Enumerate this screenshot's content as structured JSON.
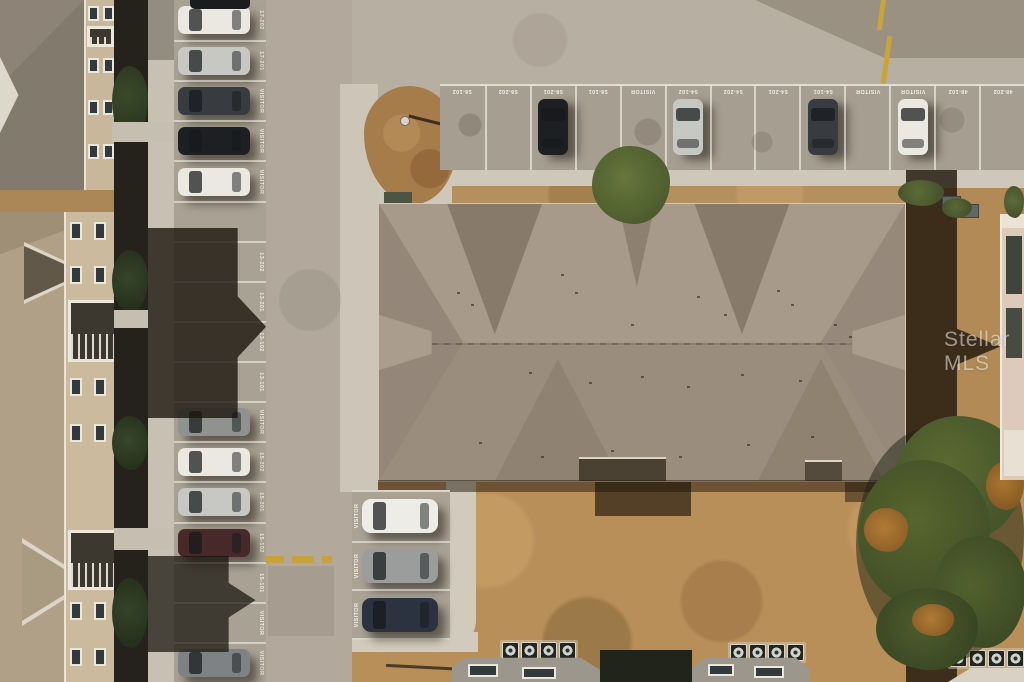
{
  "scene": {
    "type": "aerial-drone-photo",
    "description": "Overhead aerial photo of a condominium complex: large taupe hip roof at center, perpendicular parking rows at top and left with painted unit-number stall labels, dry brown lawn below, AC units along lower buildings, autumn trees at lower right.",
    "watermark": "Stellar MLS"
  },
  "palette": {
    "road": "#b7afa2",
    "parking_asphalt": "#a69e90",
    "dark_pavement_patch": "#9a9182",
    "main_roof": "#a39485",
    "roof_shadow": "rgba(33,24,14,0.8)",
    "sidewalk": "#cfc8ba",
    "dry_grass": "#b88f58",
    "mulch_island": "#a67c4b",
    "tree_green": "#57652f",
    "tree_orange": "#b07c35",
    "building_wall": "#cbb99d",
    "left_roof_tan": "#b0a088",
    "stall_line": "#f8f6ee",
    "yellow_marking": "#c9a43a"
  },
  "car_colors": {
    "white": "#eae8e1",
    "silver": "#c7c8c4",
    "black": "#1d1f22",
    "darkgray": "#383c40",
    "graysuv": "#8f928f",
    "maroon": "#47292a",
    "gray": "#7e8284",
    "navy": "#2c3340",
    "whitesuv": "#edece6",
    "graysedan": "#9a9d9b"
  },
  "top_parking": {
    "stalls": [
      {
        "label": "58-102"
      },
      {
        "label": "58-202"
      },
      {
        "label": "58-201",
        "car": "black"
      },
      {
        "label": "58-101"
      },
      {
        "label": "VISITOR"
      },
      {
        "label": "54-102",
        "car": "silver"
      },
      {
        "label": "54-202"
      },
      {
        "label": "54-201"
      },
      {
        "label": "54-101",
        "car": "darkgray"
      },
      {
        "label": "VISITOR"
      },
      {
        "label": "VISITOR",
        "car": "white"
      },
      {
        "label": "48-102"
      },
      {
        "label": "48-202"
      }
    ]
  },
  "left_parking": {
    "stalls": [
      {
        "label": "17-202",
        "car": "white"
      },
      {
        "label": "17-201",
        "car": "silver"
      },
      {
        "label": "VISITOR",
        "car": "darkgray"
      },
      {
        "label": "VISITOR",
        "car": "black"
      },
      {
        "label": "VISITOR",
        "car": "white"
      },
      {
        "label": ""
      },
      {
        "label": "13-202"
      },
      {
        "label": "13-201"
      },
      {
        "label": "13-102"
      },
      {
        "label": "13-101"
      },
      {
        "label": "VISITOR",
        "car": "graysuv"
      },
      {
        "label": "15-202",
        "car": "white"
      },
      {
        "label": "15-201",
        "car": "silver"
      },
      {
        "label": "15-102",
        "car": "maroon"
      },
      {
        "label": "15-101"
      },
      {
        "label": "VISITOR"
      },
      {
        "label": "VISITOR",
        "car": "gray"
      }
    ]
  },
  "visitor_parking": {
    "stalls": [
      {
        "label": "VISITOR",
        "car": "whitesuv"
      },
      {
        "label": "VISITOR",
        "car": "graysedan"
      },
      {
        "label": "VISITOR",
        "car": "navy"
      }
    ]
  }
}
